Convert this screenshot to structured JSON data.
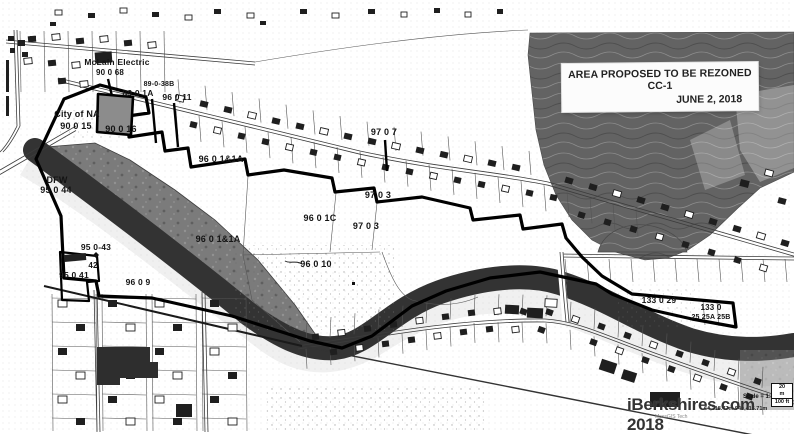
{
  "map": {
    "title_box": {
      "line1": "AREA PROPOSED TO BE REZONED CC-1",
      "line2": "JUNE 2, 2018"
    },
    "watermark": "iBerkshires.com 2018",
    "scale": {
      "label": "Scale = 1:",
      "bar_top": "20",
      "bar_mid": "m",
      "bar_bottom": "100 ft",
      "coordinates": "64,218.47m 940,415.71m",
      "attribution": "MassGIS Tech"
    },
    "colors": {
      "paper": "#ffffff",
      "river": "#333333",
      "hillside": "#636363",
      "dfw_area": "#7b7b7b",
      "boundary": "#000000",
      "label_ink": "#141414"
    },
    "labels": [
      {
        "text": "McLain Electric",
        "x": 117,
        "y": 65,
        "size": 8.5
      },
      {
        "text": "90 0 68",
        "x": 110,
        "y": 75,
        "size": 8
      },
      {
        "text": "89-0-38B",
        "x": 159,
        "y": 86,
        "size": 7
      },
      {
        "text": "89 0 1A",
        "x": 138,
        "y": 96,
        "size": 8.5
      },
      {
        "text": "96 0 11",
        "x": 177,
        "y": 100,
        "size": 8.5
      },
      {
        "text": "City of NA",
        "x": 77,
        "y": 117,
        "size": 9
      },
      {
        "text": "90 0 15",
        "x": 76,
        "y": 129,
        "size": 9
      },
      {
        "text": "90 0 16",
        "x": 121,
        "y": 132,
        "size": 9
      },
      {
        "text": "96 0 1&1A",
        "x": 221,
        "y": 162,
        "size": 9
      },
      {
        "text": "97 0 7",
        "x": 384,
        "y": 135,
        "size": 9
      },
      {
        "text": "97 0 3",
        "x": 378,
        "y": 198,
        "size": 9
      },
      {
        "text": "96 0 1C",
        "x": 320,
        "y": 221,
        "size": 9
      },
      {
        "text": "97 0 3",
        "x": 366,
        "y": 229,
        "size": 9
      },
      {
        "text": "96 0 1&1A",
        "x": 218,
        "y": 242,
        "size": 9
      },
      {
        "text": "96 0 10",
        "x": 316,
        "y": 267,
        "size": 9
      },
      {
        "text": "DFW",
        "x": 57,
        "y": 183,
        "size": 9
      },
      {
        "text": "95 0 44",
        "x": 56,
        "y": 193,
        "size": 9
      },
      {
        "text": "95 0-43",
        "x": 96,
        "y": 250,
        "size": 8.5
      },
      {
        "text": "42",
        "x": 93,
        "y": 268,
        "size": 8
      },
      {
        "text": "95 0 41",
        "x": 74,
        "y": 278,
        "size": 8.5
      },
      {
        "text": "96 0 9",
        "x": 138,
        "y": 285,
        "size": 8.5
      },
      {
        "text": "133 0 29",
        "x": 659,
        "y": 303,
        "size": 8.5
      },
      {
        "text": "133 0",
        "x": 711,
        "y": 310,
        "size": 8
      },
      {
        "text": "25 25A 25B",
        "x": 711,
        "y": 319,
        "size": 7
      }
    ]
  }
}
